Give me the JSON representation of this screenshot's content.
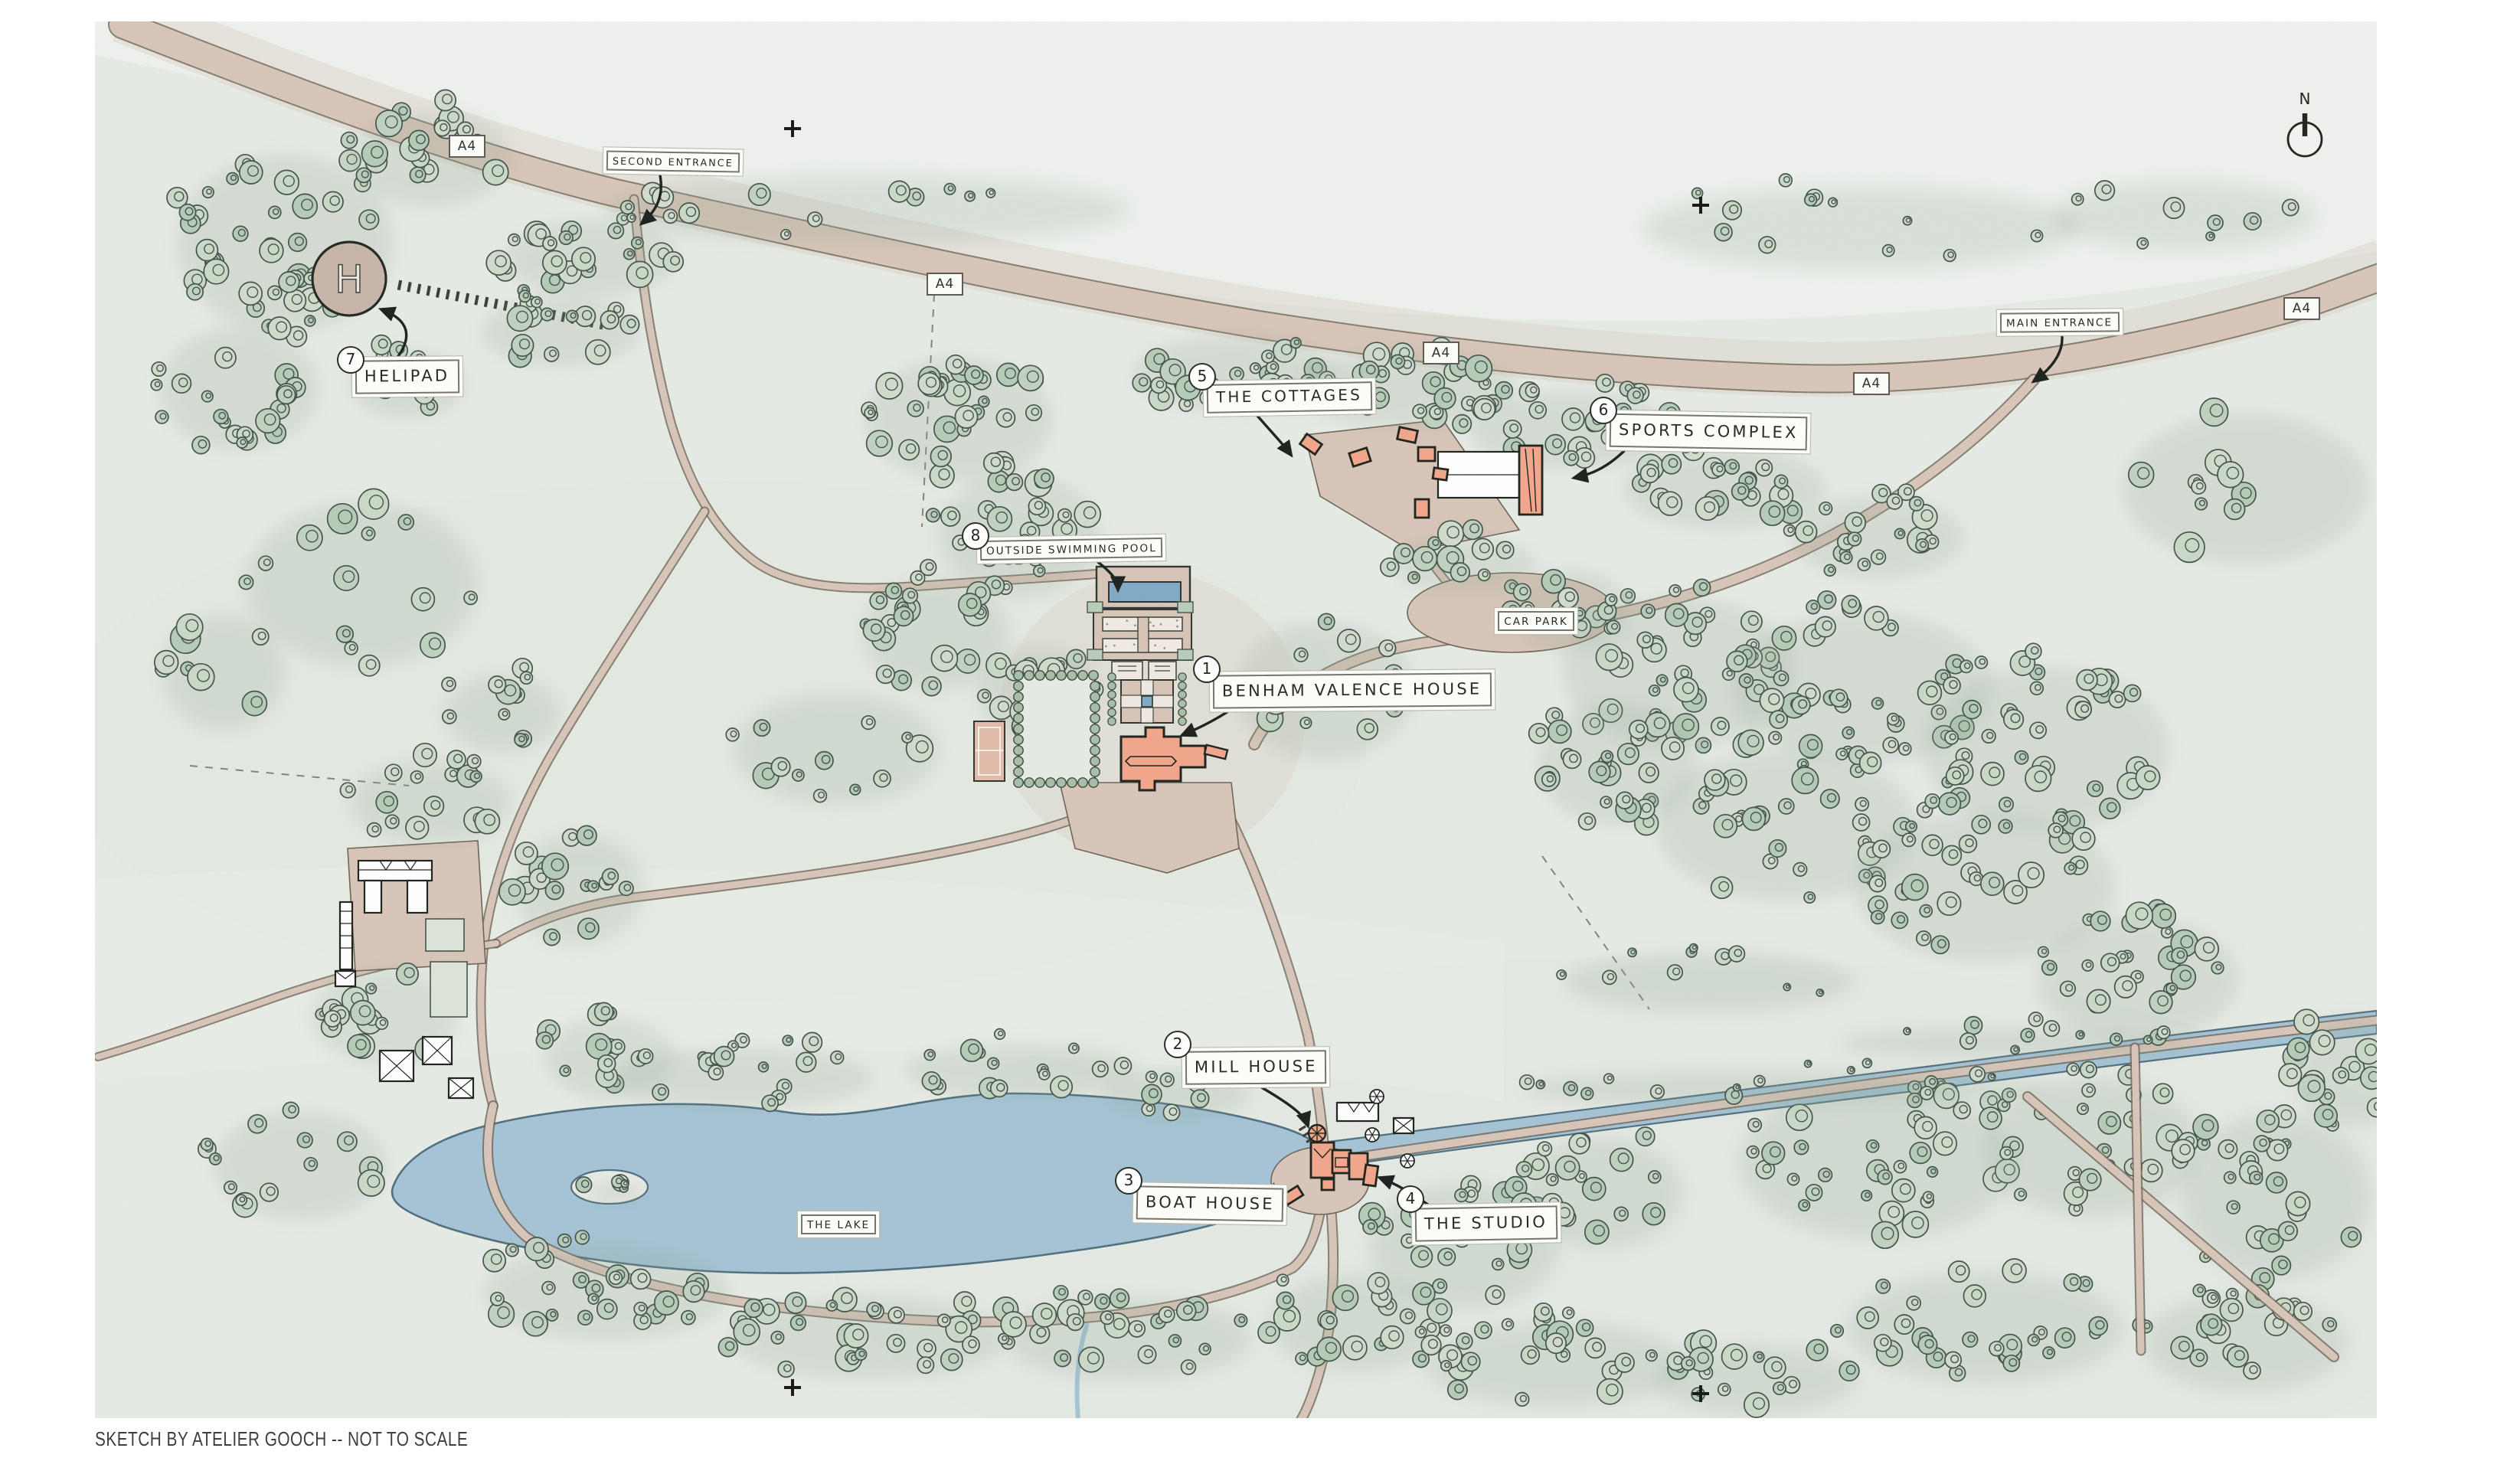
{
  "map": {
    "attribution": "SKETCH BY ATELIER GOOCH -- NOT TO SCALE",
    "compass_label": "N",
    "road_badge": "A4",
    "helipad_symbol": "H",
    "colors": {
      "building_accent": "#f2a78c",
      "water": "#a6c4d6",
      "tree_fill": "#c5d4c3",
      "road_fill": "#d8c6b9",
      "road_edge": "#6f6558",
      "ink": "#22261f"
    },
    "labels": {
      "house": {
        "num": "1",
        "text": "BENHAM VALENCE HOUSE"
      },
      "mill": {
        "num": "2",
        "text": "MILL HOUSE"
      },
      "boat": {
        "num": "3",
        "text": "BOAT HOUSE"
      },
      "studio": {
        "num": "4",
        "text": "THE STUDIO"
      },
      "cottages": {
        "num": "5",
        "text": "THE COTTAGES"
      },
      "sports": {
        "num": "6",
        "text": "SPORTS COMPLEX"
      },
      "helipad": {
        "num": "7",
        "text": "HELIPAD"
      },
      "pool": {
        "num": "8",
        "text": "OUTSIDE SWIMMING POOL"
      },
      "carpark": {
        "text": "CAR PARK"
      },
      "main_entrance": {
        "text": "MAIN ENTRANCE"
      },
      "second_entrance": {
        "text": "SECOND ENTRANCE"
      },
      "lake": {
        "text": "THE LAKE"
      }
    }
  }
}
